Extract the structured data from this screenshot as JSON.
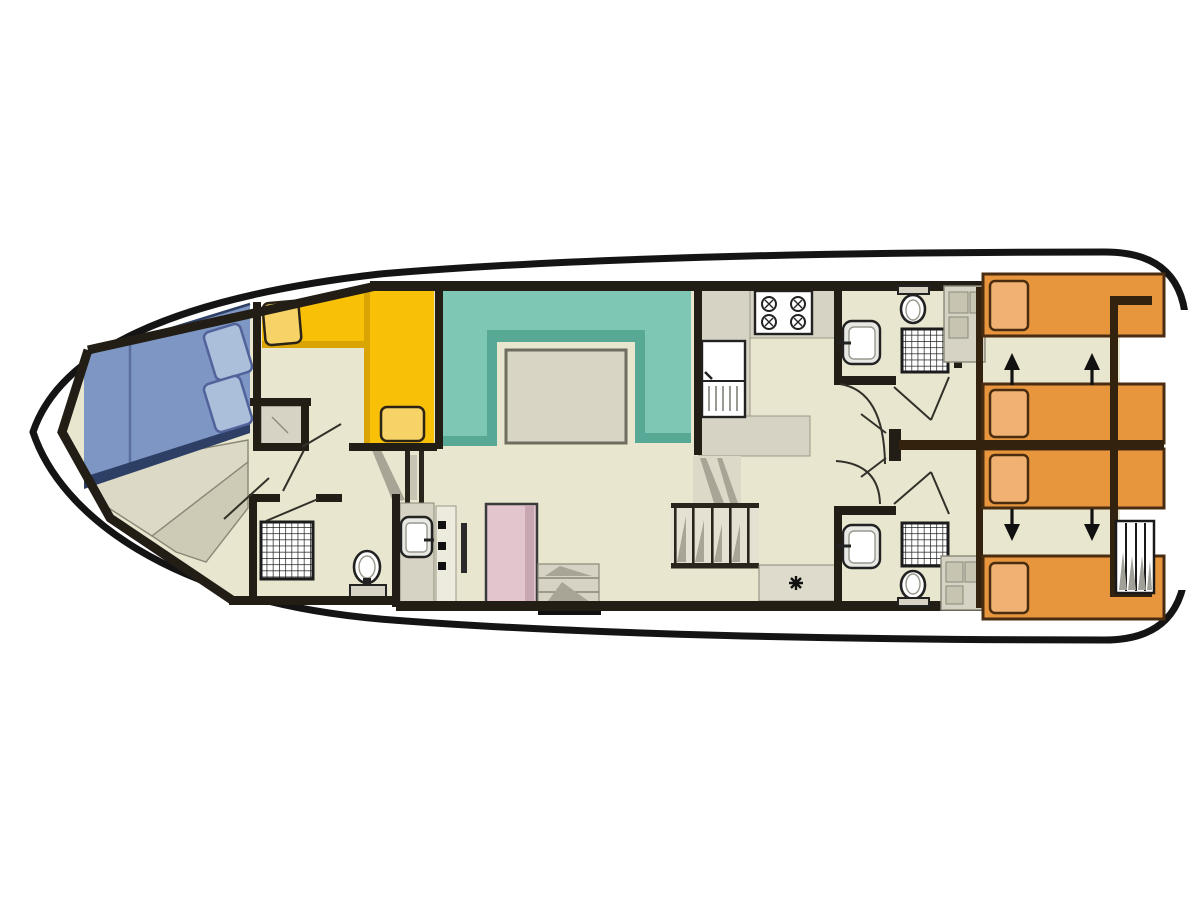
{
  "meta": {
    "type": "houseboat-floor-plan",
    "view": "top-down deck plan, bow pointing left",
    "canvas": {
      "width": 1200,
      "height": 900
    }
  },
  "palette": {
    "background": "#ffffff",
    "hull_outline": "#141414",
    "hull_fill": "#ffffff",
    "wall": "#221d15",
    "wall_brown": "#33220e",
    "floor": "#e9e6cf",
    "furniture_gray": "#d6d3c4",
    "furniture_gray_inner": "#c7c4b2",
    "facet_light": "#dcd9c6",
    "facet_dark": "#cdcab6",
    "sofa_teal": "#7ec7b5",
    "sofa_teal_shade": "#57a996",
    "table_gray": "#d8d5c5",
    "bed_yellow": "#f9c008",
    "bed_yellow_shade": "#d9a404",
    "pillow_yellow": "#f6d267",
    "bed_blue": "#7e96c3",
    "bed_blue_dark": "#2e3f66",
    "pillow_blue": "#abbfdb",
    "bed_orange": "#e8963e",
    "bed_orange_border": "#4a2c10",
    "pillow_orange": "#f0b173",
    "wardrobe_pink": "#e3c5ce",
    "wardrobe_pink_shade": "#c9a7b2",
    "stair_rail": "#2a251c",
    "stair_tread_shade": "#a8a596",
    "stair_tread_light": "#e4e1d3",
    "fixture_white": "#ffffff",
    "arrow_black": "#111111"
  },
  "rooms": [
    {
      "id": "bow-cabin",
      "name": "bow cabin",
      "furniture": [
        "double berth (blue)",
        "2 pillows",
        "nightstand",
        "stepped platform"
      ]
    },
    {
      "id": "front-cabin",
      "name": "front cabin",
      "furniture": [
        "L-shaped twin berths (yellow)",
        "2 pillows"
      ]
    },
    {
      "id": "forward-bathroom",
      "name": "forward bathroom",
      "furniture": [
        "shower",
        "toilet"
      ]
    },
    {
      "id": "washroom",
      "name": "washroom niche",
      "furniture": [
        "washbasin",
        "control panel with 3 knobs",
        "handle"
      ]
    },
    {
      "id": "saloon",
      "name": "saloon",
      "furniture": [
        "U-shaped sofa (teal)",
        "table"
      ]
    },
    {
      "id": "galley",
      "name": "galley",
      "furniture": [
        "4-burner stove",
        "refrigerator",
        "L-shaped counter"
      ]
    },
    {
      "id": "companionway",
      "name": "companionway",
      "furniture": [
        "small 3-step stair",
        "pink wardrobe",
        "railed staircase",
        "entry platform with star marker"
      ]
    },
    {
      "id": "upper-bathroom",
      "name": "upper aft bathroom",
      "furniture": [
        "washbasin",
        "shower",
        "toilet",
        "locker"
      ]
    },
    {
      "id": "lower-bathroom",
      "name": "lower aft bathroom",
      "furniture": [
        "washbasin",
        "shower",
        "toilet",
        "locker"
      ]
    },
    {
      "id": "upper-aft-cabin",
      "name": "upper aft cabin",
      "furniture": [
        "2 single berths (orange)",
        "2 pillows",
        "slide arrows up"
      ]
    },
    {
      "id": "lower-aft-cabin",
      "name": "lower aft cabin",
      "furniture": [
        "2 single berths (orange)",
        "2 pillows",
        "slide arrows down"
      ]
    },
    {
      "id": "aft-deck",
      "name": "aft deck / stairwell",
      "furniture": [
        "boarding ladder"
      ]
    }
  ],
  "counts": {
    "berths": 8,
    "stove_burners": 4,
    "showers": 3,
    "toilets": 3,
    "washbasins": 3,
    "arrows_up": 2,
    "arrows_down": 2,
    "star_markers": 1
  }
}
